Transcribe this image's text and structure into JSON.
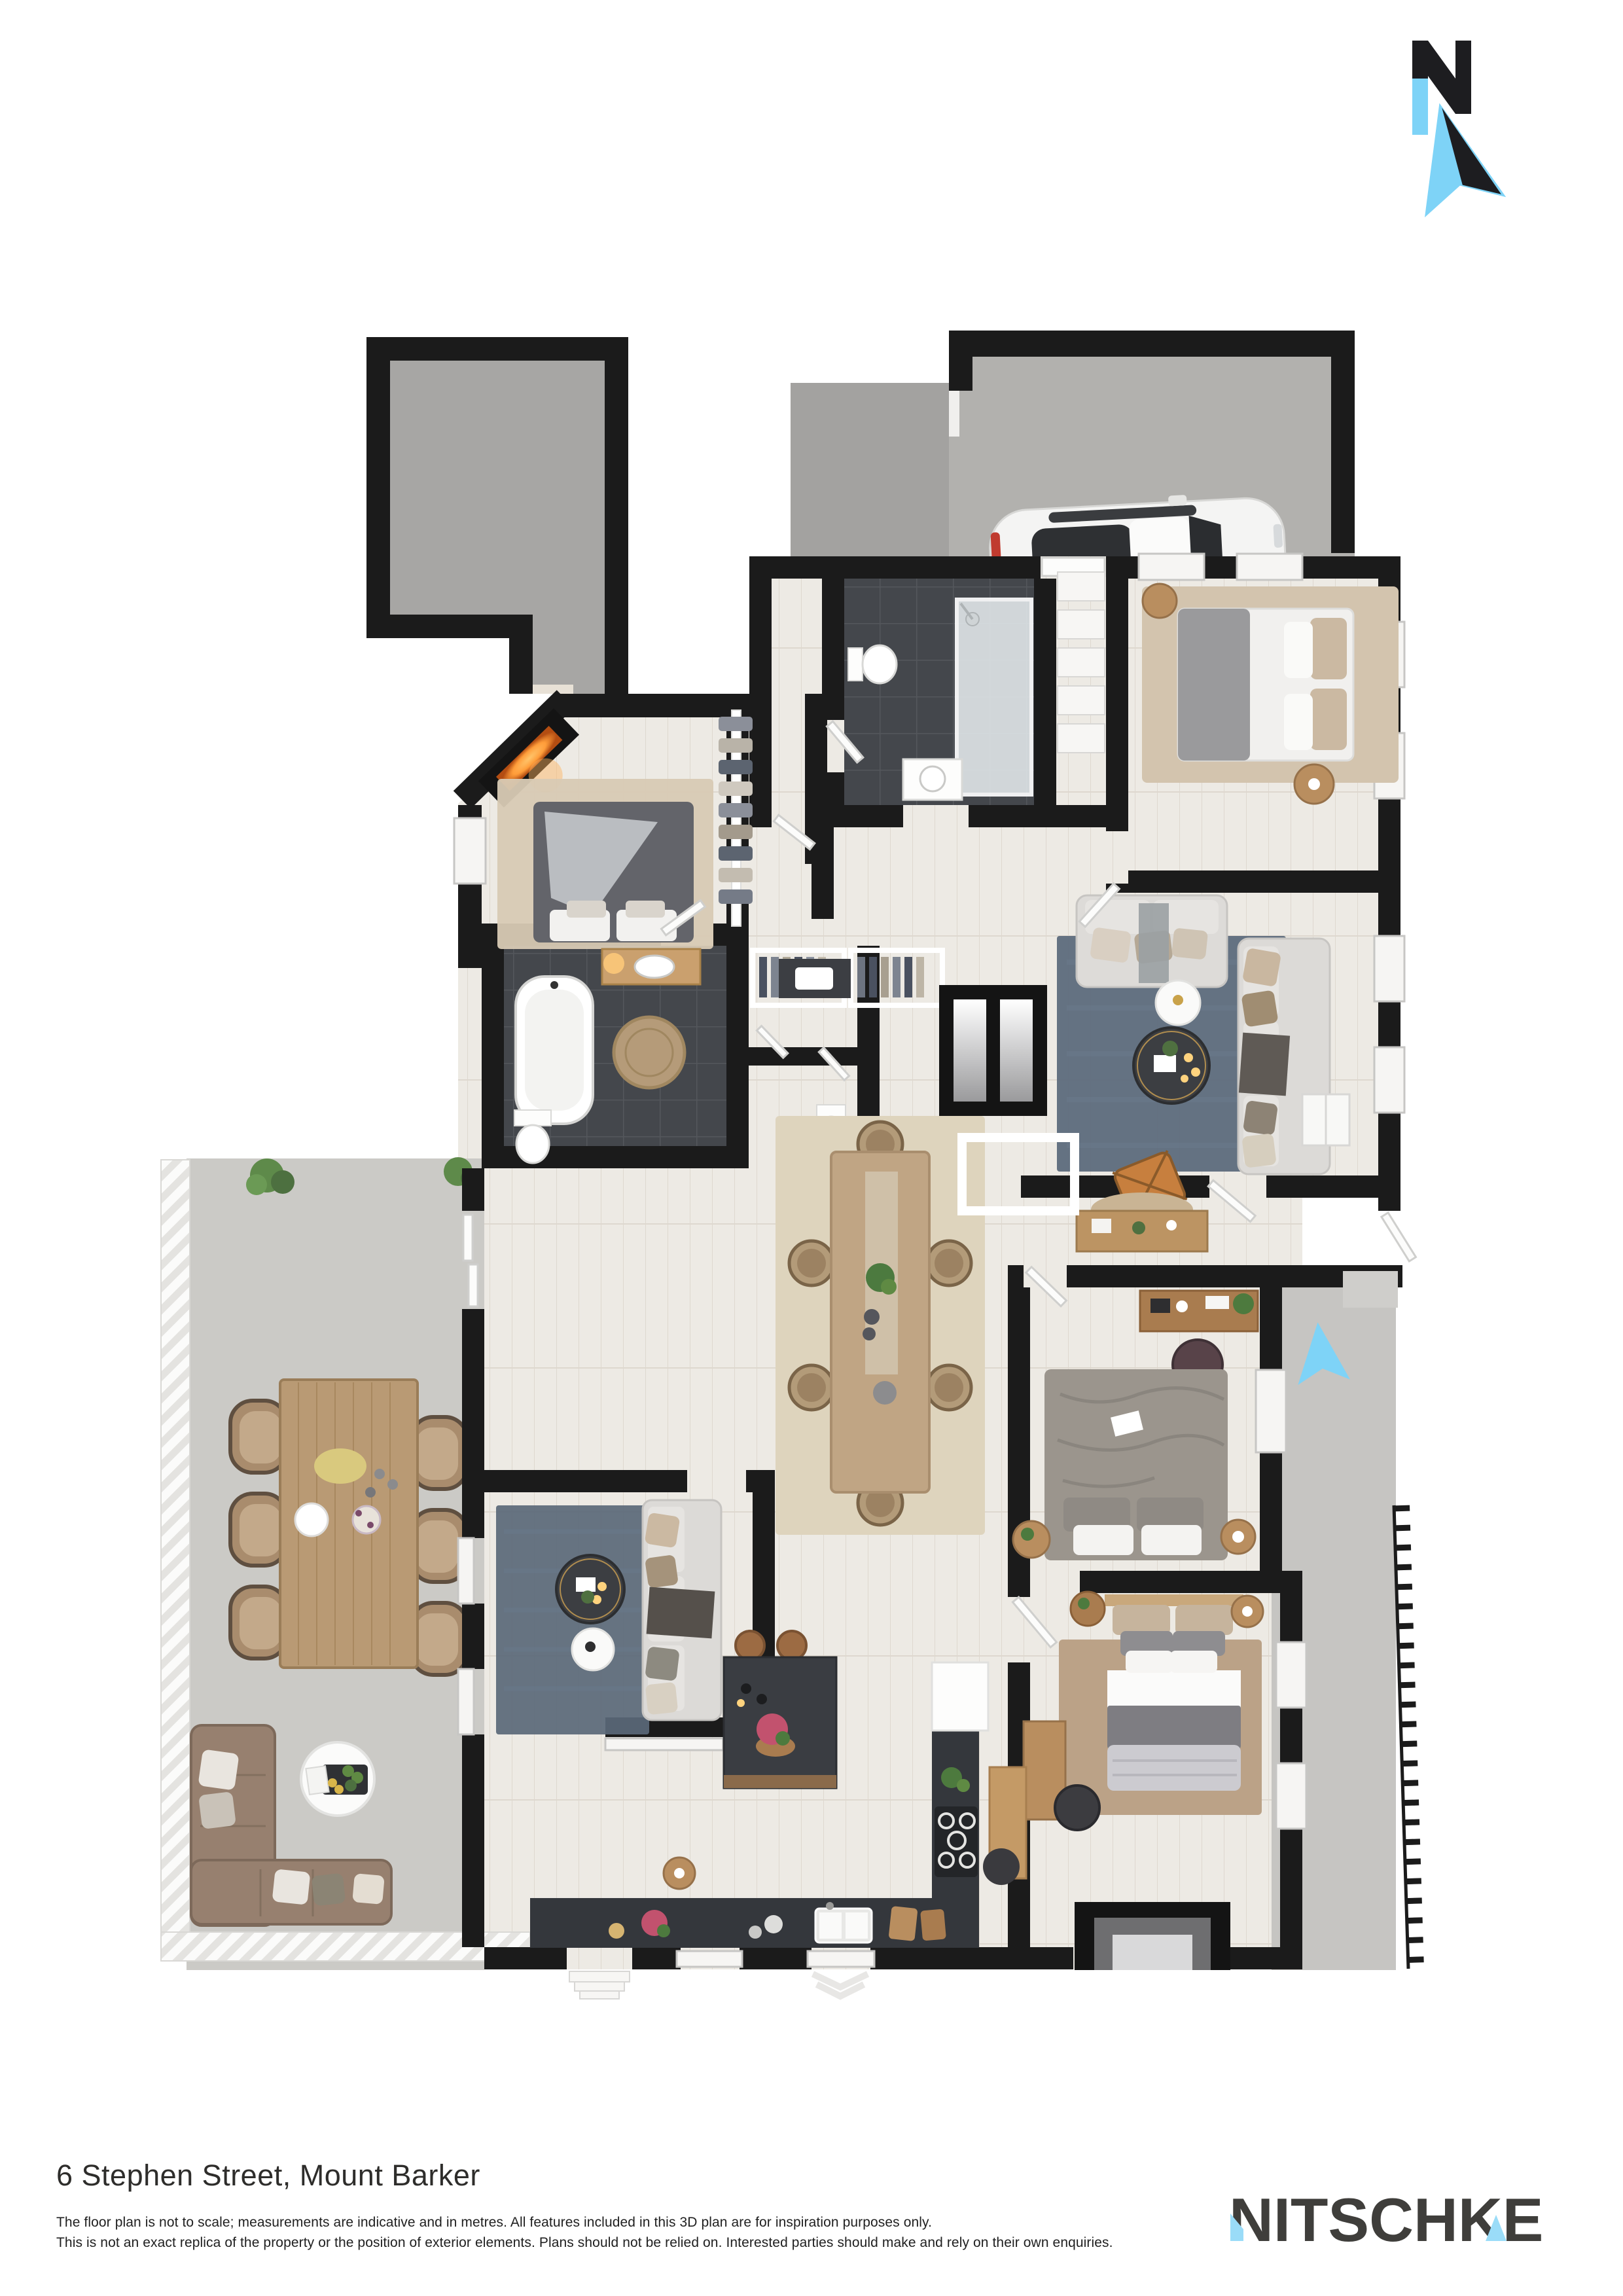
{
  "compass": {
    "letter": "N"
  },
  "footer": {
    "address": "6 Stephen Street, Mount Barker",
    "disclaimer_line1": "The floor plan is not to scale; measurements are indicative and in metres. All features included in this 3D plan are for inspiration purposes only.",
    "disclaimer_line2": "This is not an exact replica of the property or the position of exterior elements. Plans should not be relied on. Interested parties should make and rely on their own enquiries.",
    "brand": "NITSCHKE"
  },
  "colors": {
    "wall": "#1b1b1b",
    "accent_blue": "#7ed3f7",
    "logo_blue": "#9adcf8",
    "logo_text": "#3f3e3b",
    "wood_floor": "#edeae4",
    "dark_tile": "#44474c",
    "garage_concrete": "#a7a6a4",
    "carport_concrete": "#b2b1ae",
    "patio_concrete": "#cbcac6",
    "side_path_concrete": "#c6c5c2",
    "rug_blue": "#5d6b7c",
    "rug_beige": "#d8cab4",
    "sofa_gray": "#dcdad7",
    "outdoor_sofa_brown": "#97806f",
    "kitchen_dark": "#34373c",
    "timber": "#b98e5f",
    "car_body": "#f4f4f3"
  }
}
